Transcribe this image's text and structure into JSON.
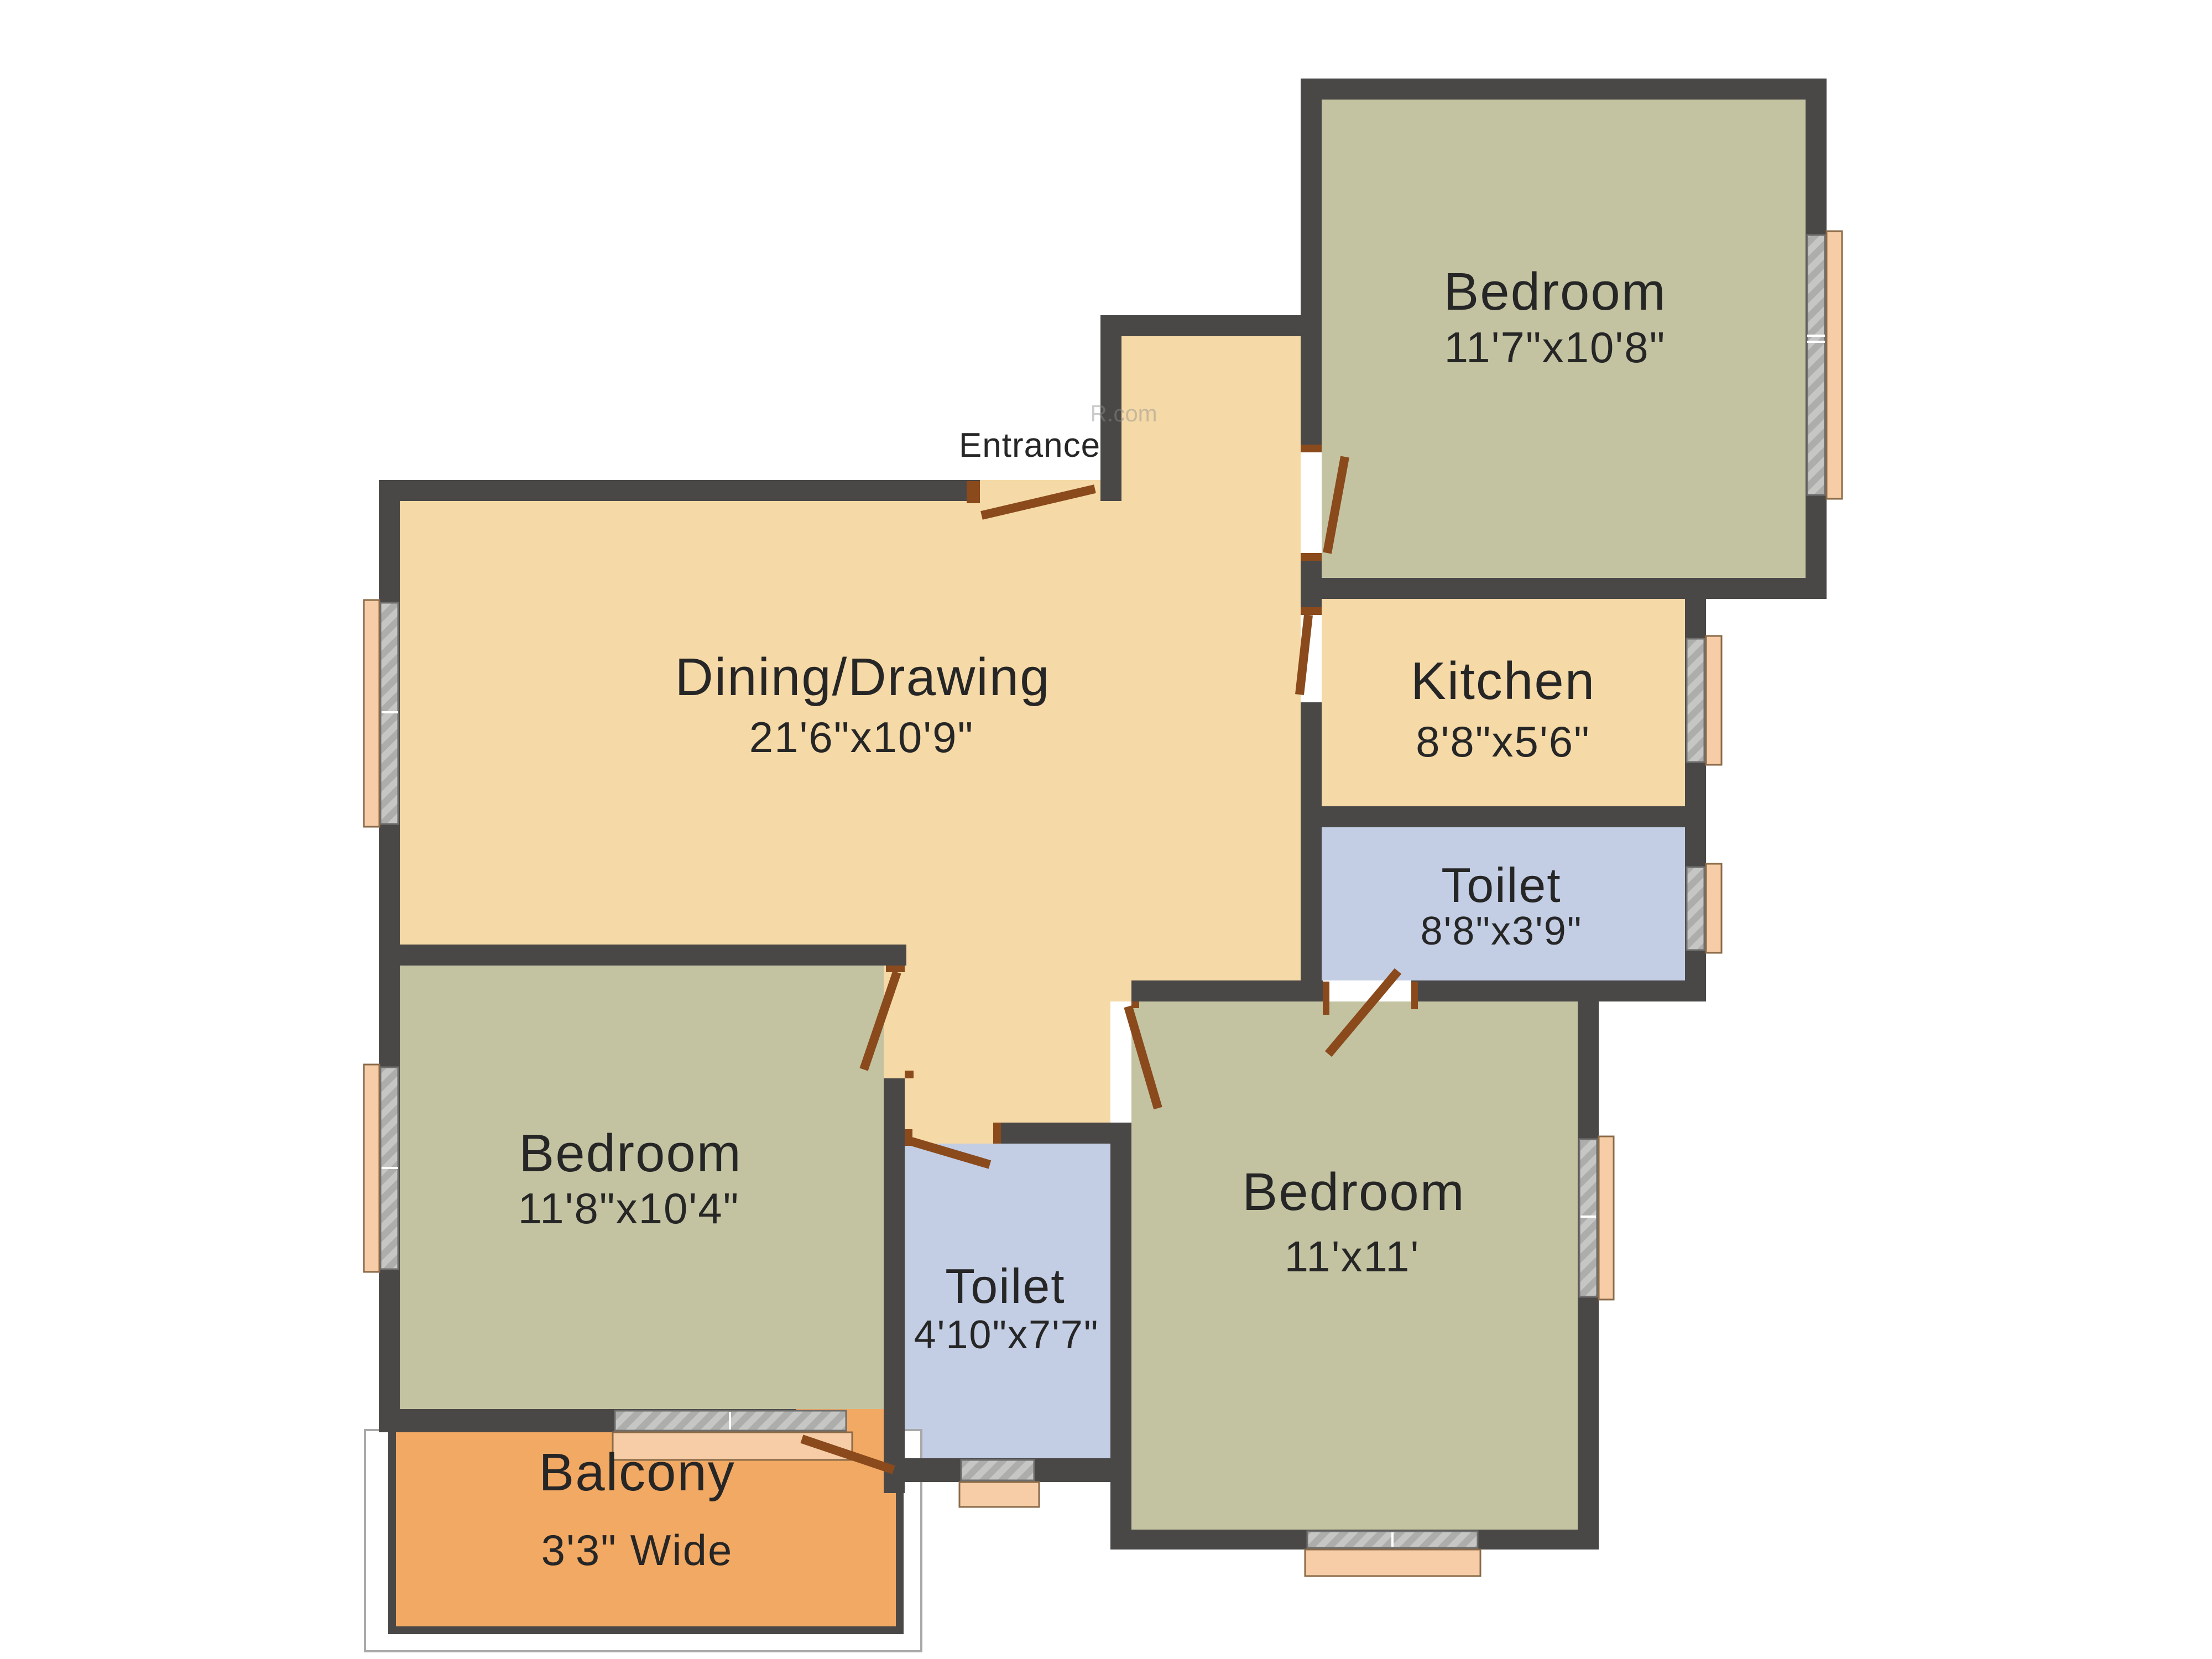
{
  "plan": {
    "watermark": "R.com",
    "entrance_label": "Entrance",
    "colors": {
      "wall": "#4a4847",
      "bedroom": "#c3c3a2",
      "living": "#f5d9a7",
      "toilet": "#c3cee4",
      "balcony": "#f2a963",
      "window": "#f6cda7",
      "window_slot": "#bdbdbb",
      "door": "#8a4a1c",
      "text": "#262626"
    },
    "rooms": [
      {
        "id": "bedroom-top",
        "label": "Bedroom",
        "dims": "11'7\"x10'8\""
      },
      {
        "id": "kitchen",
        "label": "Kitchen",
        "dims": "8'8\"x5'6\""
      },
      {
        "id": "toilet-upper",
        "label": "Toilet",
        "dims": "8'8\"x3'9\""
      },
      {
        "id": "dining",
        "label": "Dining/Drawing",
        "dims": "21'6\"x10'9\""
      },
      {
        "id": "bedroom-left",
        "label": "Bedroom",
        "dims": "11'8\"x10'4\""
      },
      {
        "id": "toilet-lower",
        "label": "Toilet",
        "dims": "4'10\"x7'7\""
      },
      {
        "id": "bedroom-right",
        "label": "Bedroom",
        "dims": "11'x11'"
      },
      {
        "id": "balcony",
        "label": "Balcony",
        "dims": "3'3\" Wide"
      }
    ]
  }
}
